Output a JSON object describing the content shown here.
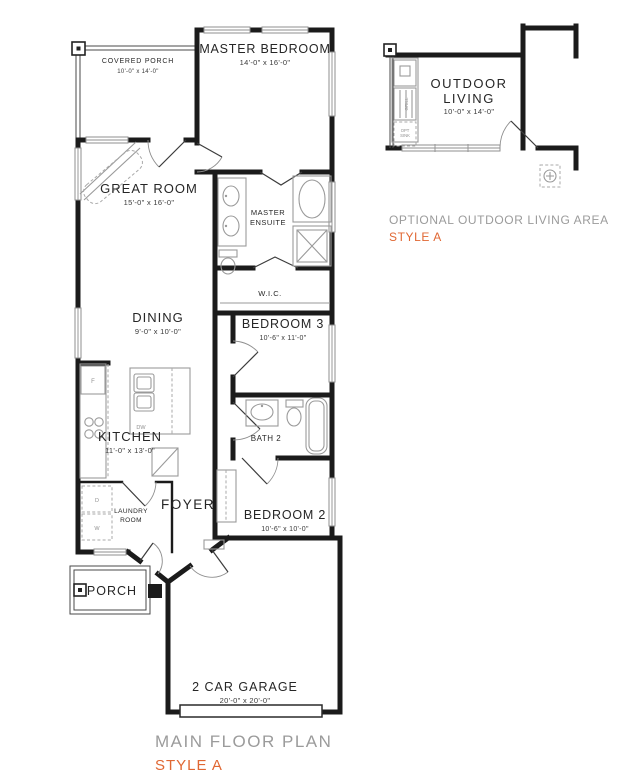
{
  "plan": {
    "rooms": {
      "covered_porch": {
        "name": "COVERED PORCH",
        "dims": "10'-0\" x 14'-0\""
      },
      "master_bedroom": {
        "name": "MASTER BEDROOM",
        "dims": "14'-0\" x 16'-0\""
      },
      "great_room": {
        "name": "GREAT ROOM",
        "dims": "15'-0\" x 16'-0\""
      },
      "master_ensuite": {
        "line1": "MASTER",
        "line2": "ENSUITE"
      },
      "wic": {
        "name": "W.I.C."
      },
      "dining": {
        "name": "DINING",
        "dims": "9'-0\" x 10'-0\""
      },
      "bedroom3": {
        "name": "BEDROOM 3",
        "dims": "10'-6\" x 11'-0\""
      },
      "kitchen": {
        "name": "KITCHEN",
        "dims": "11'-0\" x 13'-0\""
      },
      "bath2": {
        "name": "BATH 2"
      },
      "laundry": {
        "line1": "LAUNDRY",
        "line2": "ROOM"
      },
      "foyer": {
        "name": "FOYER"
      },
      "bedroom2": {
        "name": "BEDROOM 2",
        "dims": "10'-6\" x 10'-0\""
      },
      "porch": {
        "name": "PORCH"
      },
      "garage": {
        "name": "2 CAR GARAGE",
        "dims": "20'-0\" x 20'-0\""
      },
      "outdoor_living": {
        "line1": "OUTDOOR",
        "line2": "LIVING",
        "dims": "10'-0\" x 14'-0\""
      }
    },
    "appliances": {
      "dishwasher": "DW",
      "washer": "W",
      "dryer": "D",
      "fridge": "F",
      "grill": "GRILL",
      "opt_sink_line1": "OPT",
      "opt_sink_line2": "SINK"
    },
    "captions": {
      "optional_title": "OPTIONAL OUTDOOR LIVING AREA",
      "optional_style": "STYLE A",
      "main_title": "MAIN FLOOR PLAN",
      "main_style": "STYLE A"
    },
    "colors": {
      "wall": "#1b1b1b",
      "fixture": "#9a9a9a",
      "caption": "#9b9b9b",
      "accent": "#e06733"
    }
  }
}
